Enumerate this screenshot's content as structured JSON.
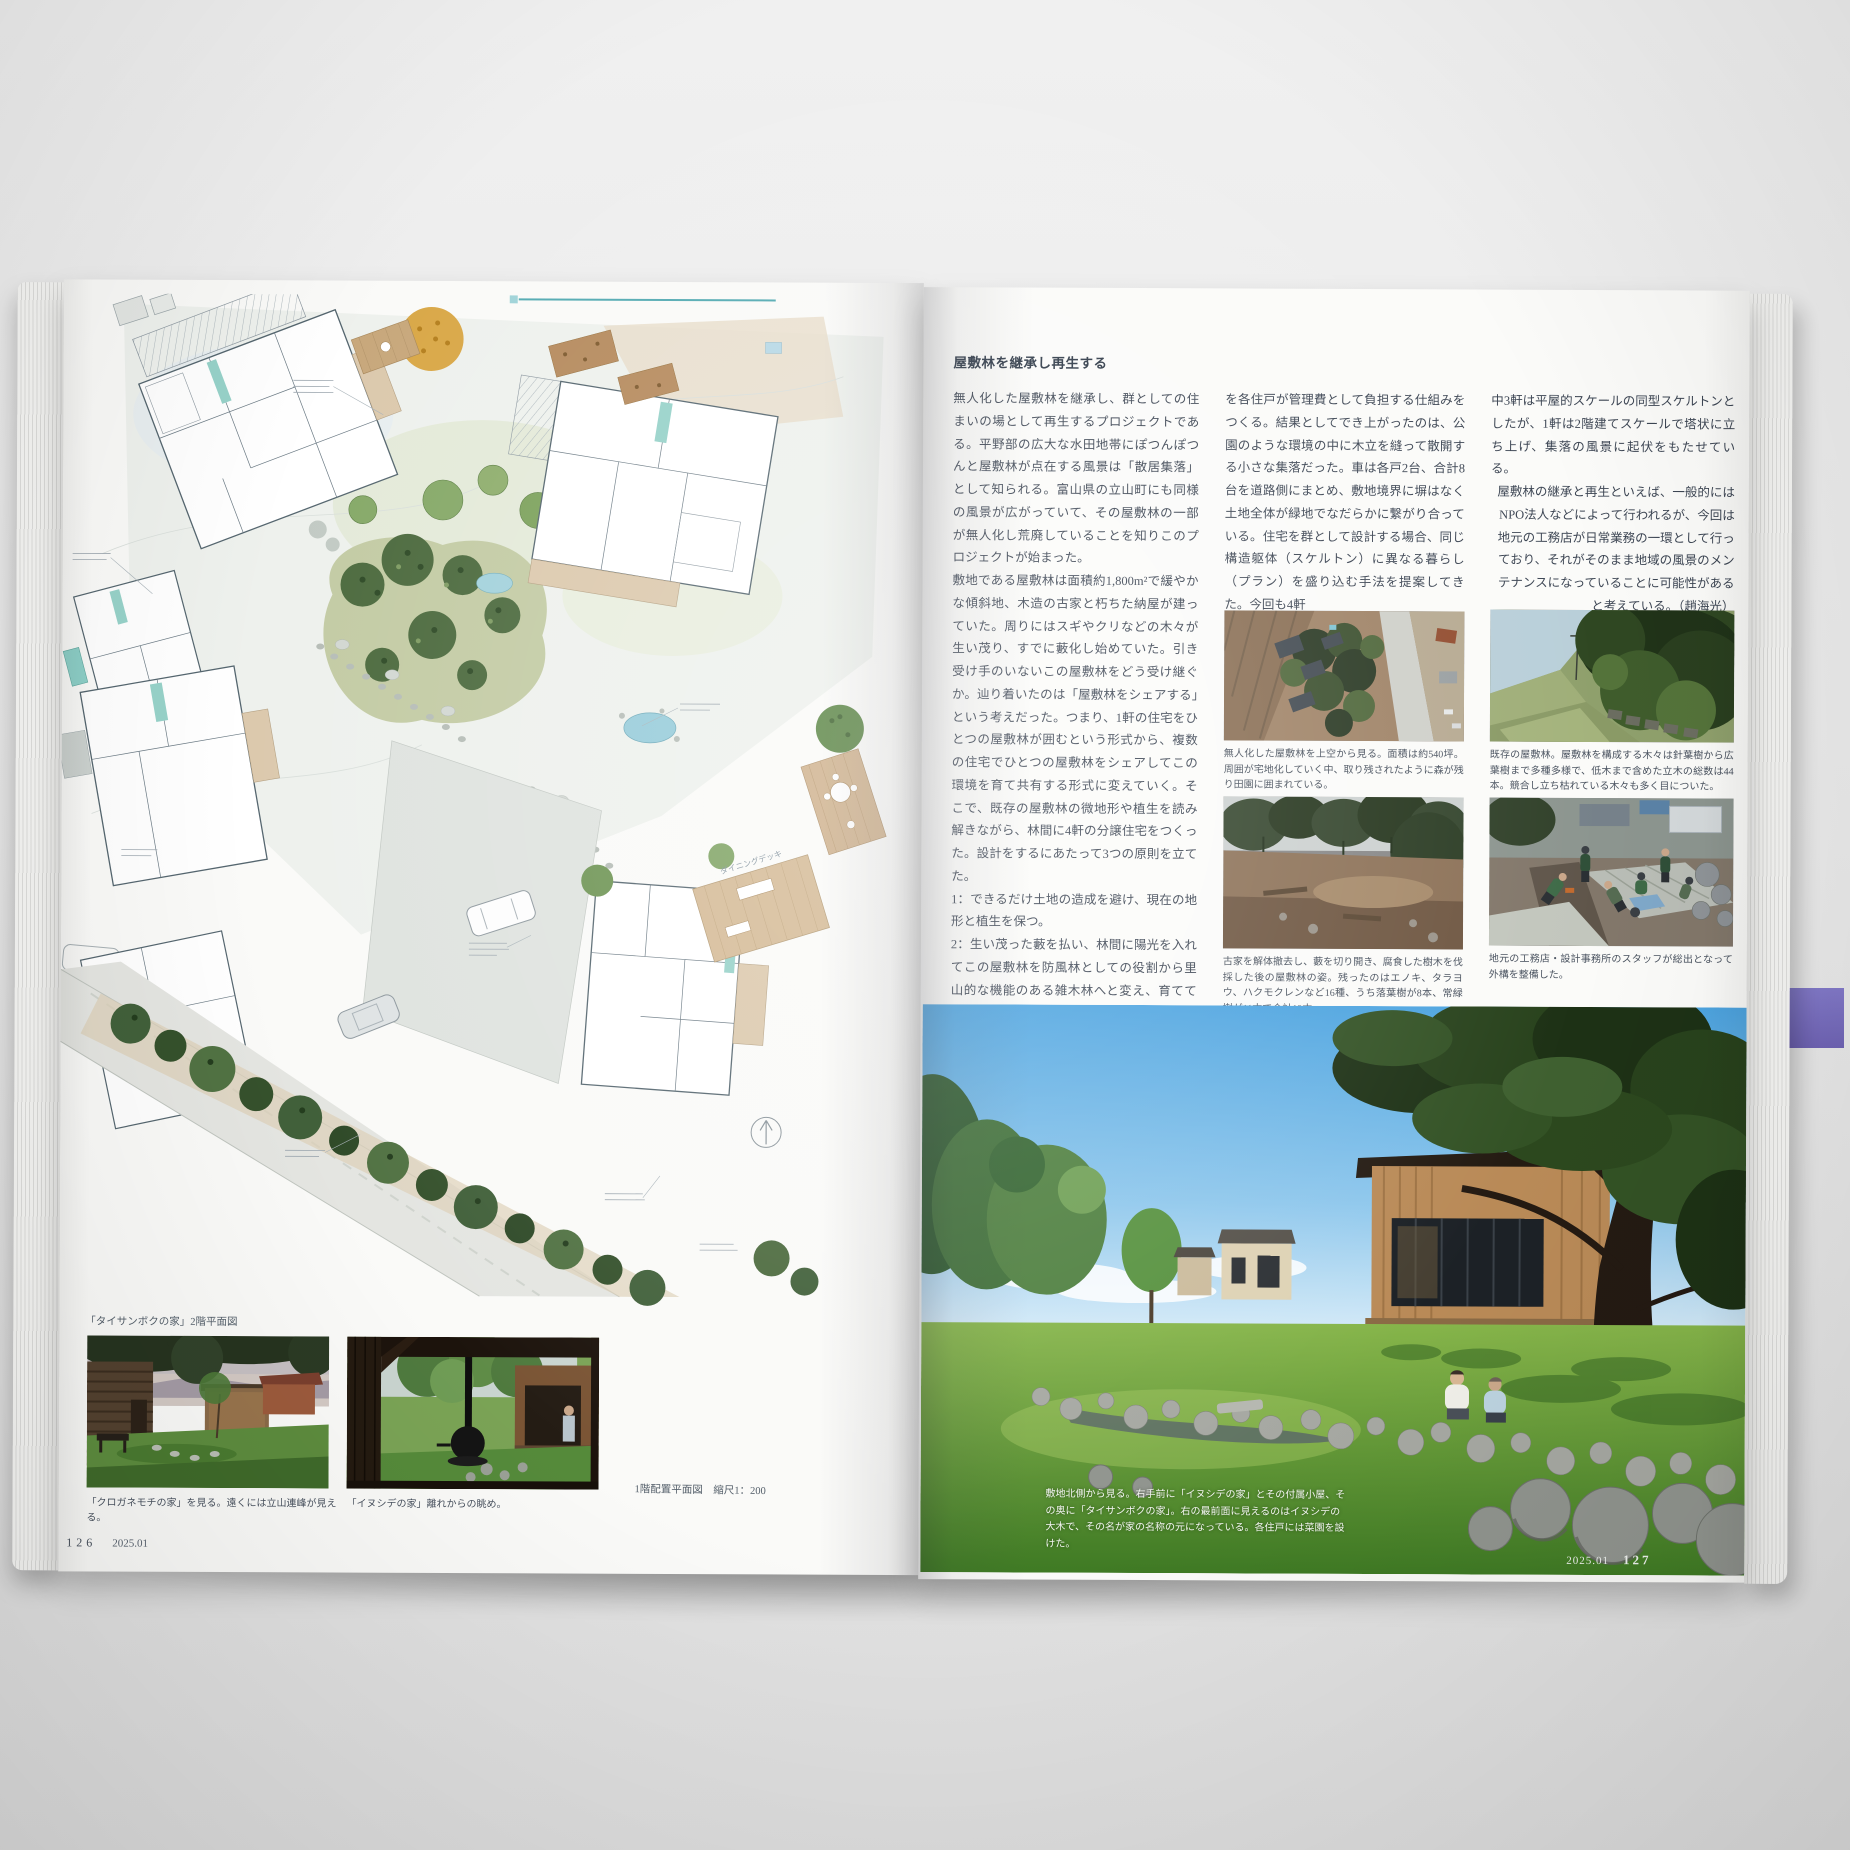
{
  "left_page": {
    "plan": {
      "scale_label": "1階配置平面図　縮尺1：200",
      "floor2_label": "「タイサンボクの家」2階平面図",
      "annotation_dining": "ダイニングデッキ"
    },
    "photo1_caption": "「クロガネモチの家」を見る。遠くには立山連峰が見える。",
    "photo2_caption": "「イヌシデの家」離れからの眺め。",
    "page_number": "126",
    "issue": "2025.01"
  },
  "right_page": {
    "heading": "屋敷林を継承し再生する",
    "col1": {
      "p1": "無人化した屋敷林を継承し、群としての住まいの場として再生するプロジェクトである。平野部の広大な水田地帯にぽつんぽつんと屋敷林が点在する風景は「散居集落」として知られる。富山県の立山町にも同様の風景が広がっていて、その屋敷林の一部が無人化し荒廃していることを知りこのプロジェクトが始まった。",
      "p2": "敷地である屋敷林は面積約1,800m²で緩やかな傾斜地、木造の古家と朽ちた納屋が建っていた。周りにはスギやクリなどの木々が生い茂り、すでに藪化し始めていた。引き受け手のいないこの屋敷林をどう受け継ぐか。辿り着いたのは「屋敷林をシェアする」という考えだった。つまり、1軒の住宅をひとつの屋敷林が囲むという形式から、複数の住宅でひとつの屋敷林をシェアしてこの環境を育て共有する形式に変えていく。そこで、既存の屋敷林の微地形や植生を読み解きながら、林間に4軒の分譲住宅をつくった。設計をするにあたって3つの原則を立てた。",
      "p3": "1：できるだけ土地の造成を避け、現在の地形と植生を保つ。",
      "p4": "2：生い茂った藪を払い、林間に陽光を入れてこの屋敷林を防風林としての役割から里山的な機能のある雑木林へと変え、育てていく。",
      "p5": "3：その長期的なビジョンを4軒の家の住み手と共有し、継続的にメンテナンスを行うための費用"
    },
    "col2": {
      "p1": "を各住戸が管理費として負担する仕組みをつくる。結果としてでき上がったのは、公園のような環境の中に木立を縫って散開する小さな集落だった。車は各戸2台、合計8台を道路側にまとめ、敷地境界に塀はなく土地全体が緑地でなだらかに繋がり合っている。住宅を群として設計する場合、同じ構造躯体（スケルトン）に異なる暮らし（プラン）を盛り込む手法を提案してきた。今回も4軒"
    },
    "col3": {
      "p1": "中3軒は平屋的スケールの同型スケルトンとしたが、1軒は2階建てスケールで塔状に立ち上げ、集落の風景に起伏をもたせている。",
      "p2": "屋敷林の継承と再生といえば、一般的にはNPO法人などによって行われるが、今回は地元の工務店が日常業務の一環として行っており、それがそのまま地域の風景のメンテナンスになっていることに可能性があると考えている。（趙海光）"
    },
    "captions": {
      "aerial": "無人化した屋敷林を上空から見る。面積は約540坪。周囲が宅地化していく中、取り残されたように森が残り田園に囲まれている。",
      "grove": "既存の屋敷林。屋敷林を構成する木々は針葉樹から広葉樹まで多種多様で、低木まで含めた立木の総数は44本。競合し立ち枯れている木々も多く目についた。",
      "cleared": "古家を解体撤去し、藪を切り開き、腐食した樹木を伐採した後の屋敷林の姿。残ったのはエノキ、タラヨウ、ハクモクレンなど16種、うち落葉樹が8本、常緑樹が11本で合計19本。",
      "workers": "地元の工務店・設計事務所のスタッフが総出となって外構を整備した。"
    },
    "hero_caption": "敷地北側から見る。右手前に「イヌシデの家」とその付属小屋、その奥に「タイサンボクの家」。右の最前面に見えるのはイヌシデの大木で、その名が家の名称の元になっている。各住戸には菜園を設けた。",
    "issue": "2025.01",
    "page_number": "127"
  }
}
